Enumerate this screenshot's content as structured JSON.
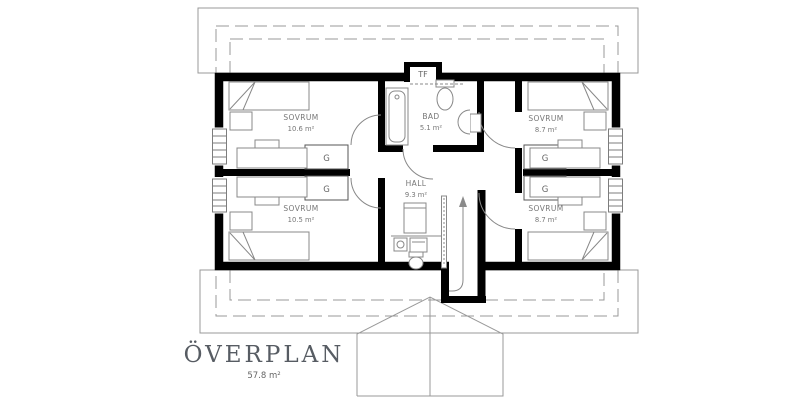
{
  "plan": {
    "title": "ÖVERPLAN",
    "title_area": "57.8 m²",
    "rooms": [
      {
        "id": "sovrum-top-left",
        "name": "SOVRUM",
        "area": "10.6 m²"
      },
      {
        "id": "sovrum-bottom-left",
        "name": "SOVRUM",
        "area": "10.5 m²"
      },
      {
        "id": "bad",
        "name": "BAD",
        "area": "5.1 m²"
      },
      {
        "id": "hall",
        "name": "HALL",
        "area": "9.3 m²"
      },
      {
        "id": "sovrum-top-right",
        "name": "SOVRUM",
        "area": "8.7 m²"
      },
      {
        "id": "sovrum-bottom-right",
        "name": "SOVRUM",
        "area": "8.7 m²"
      }
    ],
    "labels": {
      "attic_hatch": "TF",
      "wardrobe": "G"
    },
    "colors": {
      "wall": "#000000",
      "outline": "#999999",
      "furniture": "#888888",
      "text": "#777777",
      "background": "#ffffff"
    }
  }
}
